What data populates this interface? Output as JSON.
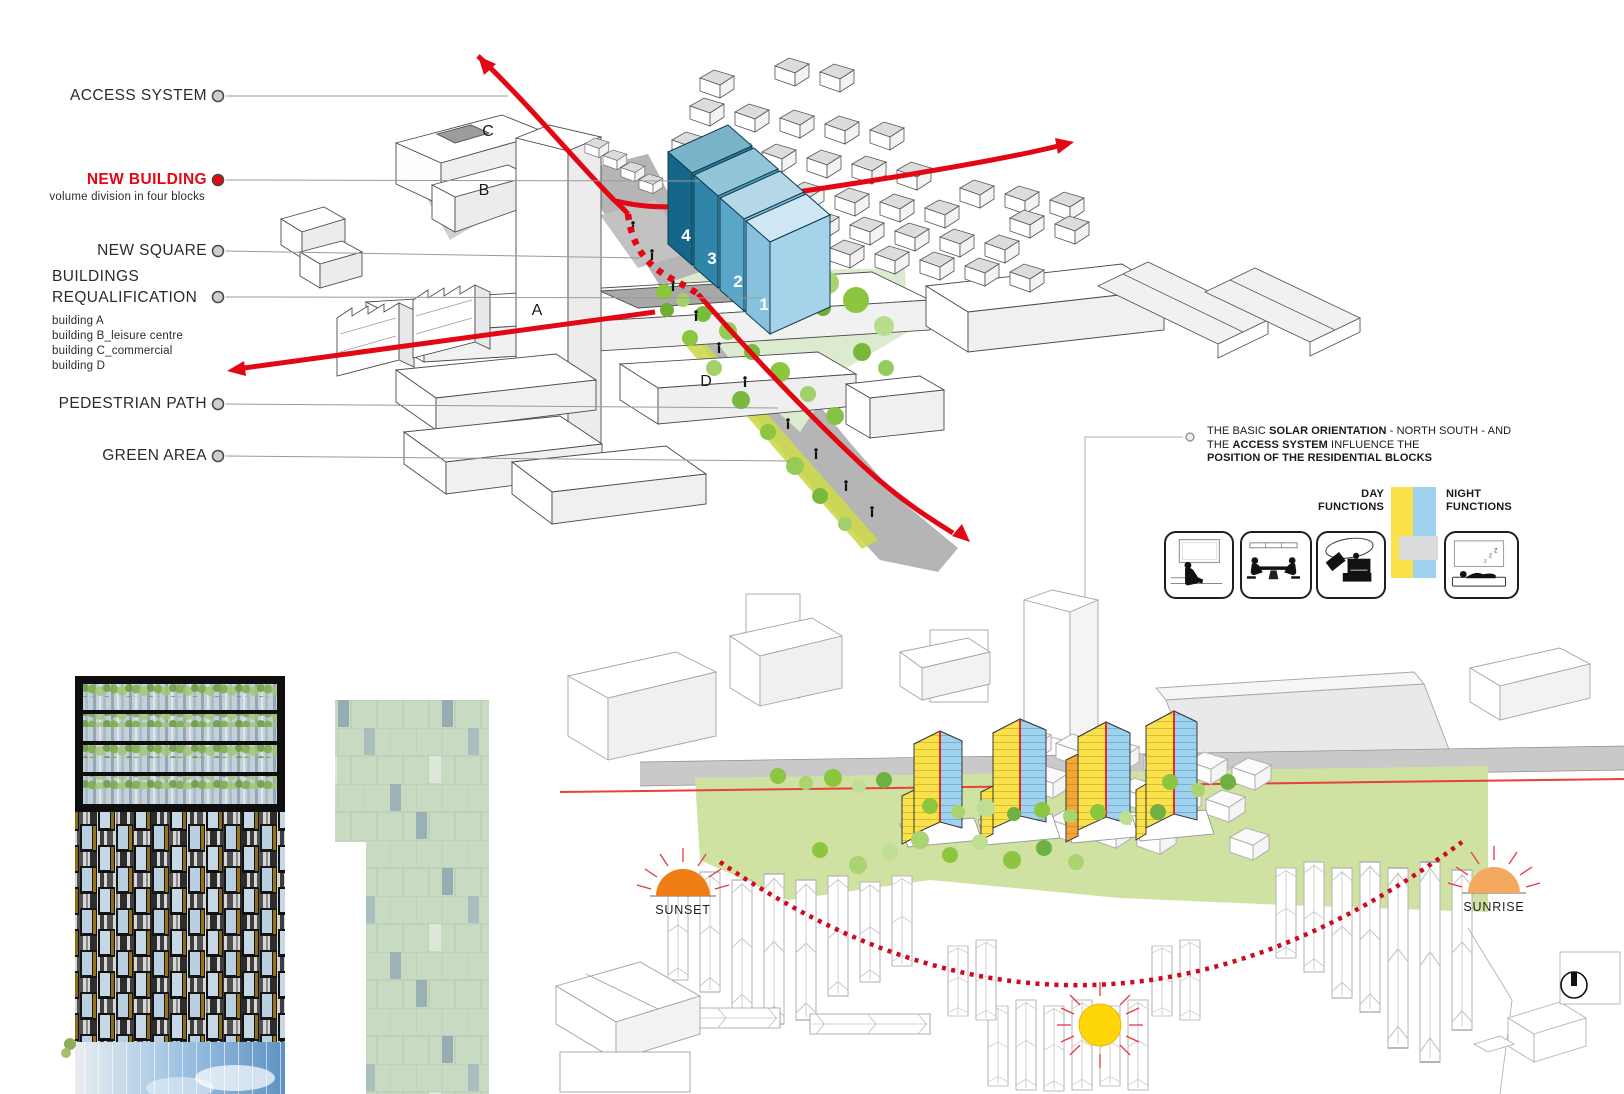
{
  "legend": {
    "items": [
      {
        "label": "ACCESS SYSTEM"
      },
      {
        "label": "NEW BUILDING",
        "sub": "volume division in four blocks"
      },
      {
        "label": "NEW SQUARE"
      },
      {
        "label": "BUILDINGS",
        "label2": "REQUALIFICATION",
        "subs": [
          "building A",
          "building B_leisure centre",
          "building C_commercial",
          "building D"
        ]
      },
      {
        "label": "PEDESTRIAN PATH"
      },
      {
        "label": "GREEN AREA"
      }
    ]
  },
  "top_diagram": {
    "block_numbers": [
      "4",
      "3",
      "2",
      "1"
    ],
    "letters": {
      "a": "A",
      "b": "B",
      "c": "C",
      "d": "D"
    }
  },
  "solar_note": {
    "l1a": "THE BASIC ",
    "l1b": "SOLAR ORIENTATION",
    "l1c": " - NORTH SOUTH - AND",
    "l2a": "THE ",
    "l2b": "ACCESS SYSTEM",
    "l2c": " INFLUENCE THE",
    "l3": "POSITION OF THE RESIDENTIAL BLOCKS",
    "day_line1": "DAY",
    "day_line2": "FUNCTIONS",
    "night_line1": "NIGHT",
    "night_line2": "FUNCTIONS"
  },
  "solar_diagram": {
    "sunset_label": "SUNSET",
    "sunrise_label": "SUNRISE",
    "zzz": [
      "z",
      "z",
      "z"
    ]
  },
  "colors": {
    "accent_red": "#e30613",
    "new_building_blues": [
      "#2a7fa2",
      "#4f9fbf",
      "#7dbcda",
      "#a5d3ea"
    ],
    "tower_yellow": "#fbe24a",
    "tower_blue": "#9fd2ee",
    "tower_orange": "#f5a733",
    "green_area": "#dcead0",
    "street_gray": "#b5b5b5",
    "sun_yellow": "#ffd60a",
    "sunset_orange": "#f07c16",
    "sunrise_orange": "#f5a95f"
  }
}
